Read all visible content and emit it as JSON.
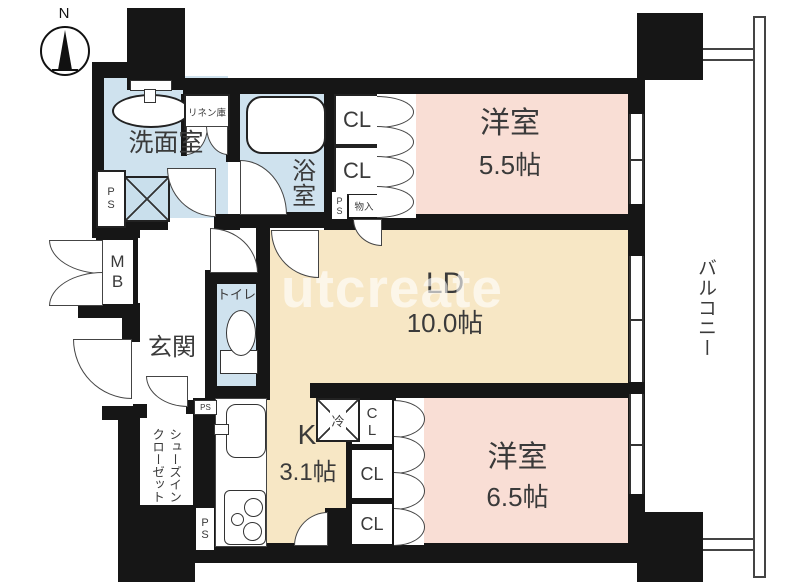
{
  "compass": {
    "north_label": "N"
  },
  "watermark": {
    "text": "utcreate"
  },
  "rooms": {
    "washroom": {
      "label": "洗面室"
    },
    "bath": {
      "label": "浴室"
    },
    "linen_closet": {
      "label": "リネン庫"
    },
    "toilet": {
      "label": "トイレ"
    },
    "entrance": {
      "label": "玄関"
    },
    "meter_box": {
      "label": "MB"
    },
    "shoe_closet": {
      "line1": "シューズイン",
      "line2": "クローゼット"
    },
    "western_room_1": {
      "name": "洋室",
      "size": "5.5帖"
    },
    "living_dining": {
      "name": "LD",
      "size": "10.0帖"
    },
    "kitchen": {
      "name": "K",
      "size": "3.1帖"
    },
    "western_room_2": {
      "name": "洋室",
      "size": "6.5帖"
    },
    "balcony": {
      "label": "バルコニー"
    }
  },
  "labels": {
    "closet": "CL",
    "pipe_space": "PS",
    "storage": "物入",
    "refrigerator": "冷"
  },
  "colors": {
    "wall": "#161616",
    "wet_area": "#cfe2ee",
    "western_room": "#f9ded5",
    "ldk": "#f7e7c5"
  }
}
